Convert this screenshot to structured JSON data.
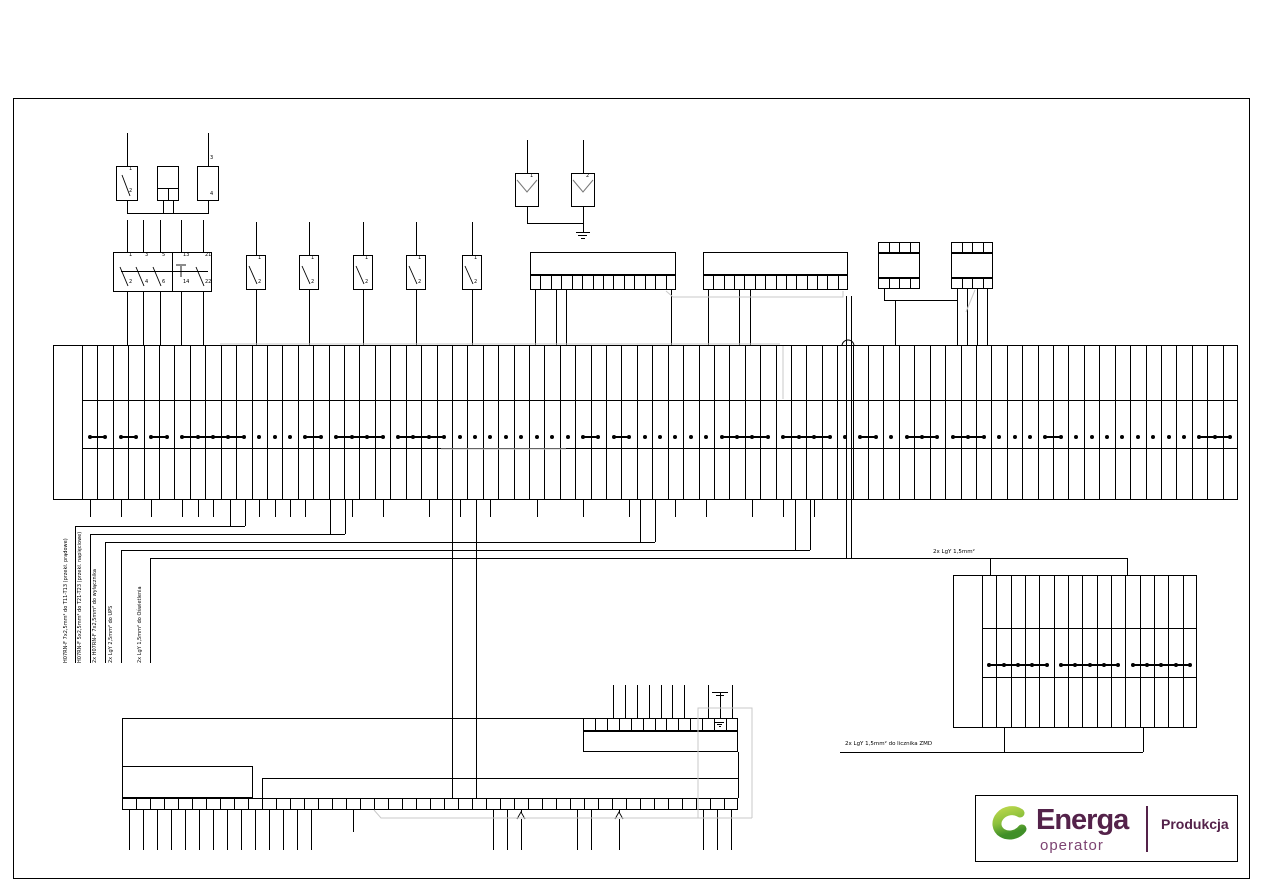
{
  "colors": {
    "line": "#000000",
    "gray": "#c9c9c9",
    "background": "#ffffff"
  },
  "logo": {
    "brand": "Energa",
    "sub": "operator",
    "right": "Produkcja",
    "brand_color": "#54224a",
    "operator_color": "#7d4472",
    "divider_color": "#54224a",
    "green_light": "#b5d44a",
    "green_dark": "#3f8f28"
  },
  "labels": {
    "cable_runs": [
      "H07RN-F 7x2,5mm² do T11-T13 (przekł. prądowe)",
      "H07RN-F 5x2,5mm² do T21-T23 (przekł. napięciowe)",
      "2x H07RN-F 7x2,5mm² do wyłącznika",
      "2x LgY 2,5mm² do UPS",
      "2x LgY 1,5mm² do Oświetlenia"
    ],
    "lighting_line": "2x LgY 1,5mm²",
    "meter_line": "2x LgY 1,5mm² do licznika ZMD"
  },
  "devices": {
    "input_switch": {
      "top_pin": "1",
      "bottom_pin": "2"
    },
    "aux_device": {
      "top_pin": "3",
      "bottom_pin": "4"
    },
    "three_pole_breaker": {
      "top_pins": [
        "1",
        "3",
        "5",
        "13",
        "21"
      ],
      "bottom_pins": [
        "2",
        "4",
        "6",
        "14",
        "22"
      ]
    },
    "single_breakers": {
      "count": 5,
      "top_pin": "1",
      "bottom_pin": "2"
    },
    "surge_arresters": {
      "labels": [
        "1",
        "2"
      ]
    }
  },
  "strips": {
    "main": {
      "cells": 75,
      "links": [
        [
          1,
          2
        ],
        [
          3,
          4
        ],
        [
          5,
          6
        ],
        [
          7,
          11
        ],
        [
          15,
          16
        ],
        [
          17,
          20
        ],
        [
          21,
          24
        ],
        [
          33,
          34
        ],
        [
          35,
          36
        ],
        [
          42,
          45
        ],
        [
          46,
          49
        ],
        [
          51,
          52
        ],
        [
          54,
          56
        ],
        [
          57,
          59
        ],
        [
          63,
          64
        ],
        [
          73,
          75
        ]
      ]
    },
    "right": {
      "cells": 15,
      "links": [
        [
          1,
          5
        ],
        [
          6,
          10
        ],
        [
          11,
          15
        ]
      ]
    },
    "strip_a": {
      "cells": 14
    },
    "strip_b": {
      "cells": 14
    },
    "relay_blocks": {
      "count": 2,
      "cells_per_row": 4
    },
    "bottom_block": {
      "upper_cells": 13,
      "lower_cells": 44
    }
  }
}
